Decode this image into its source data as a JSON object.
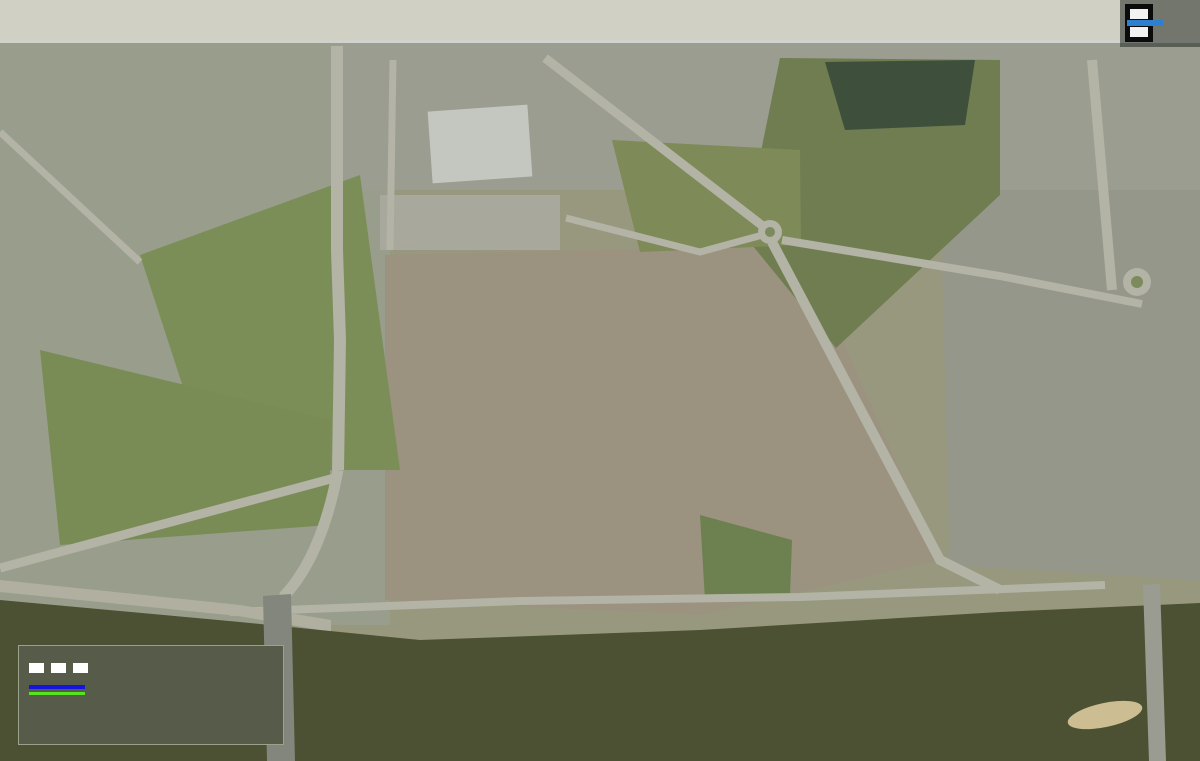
{
  "title": {
    "line1": "OBSZAR ZESPOŁU STAROMIEJSKIEGO WRAZ Z OTOCZENIEM W TORUNIU",
    "line2": "- PODZIAŁ NA KWARTAŁY URBANISTYCZNE W MPZP."
  },
  "logo": {
    "org_line1": "MIEJSKA",
    "org_line2": "PRACOWNIA",
    "org_line3": "URBANISTYCZNA",
    "org_line4": "W TORUNIU"
  },
  "legend": {
    "heading": "OZNACZENIA:",
    "items": [
      {
        "id": "plan-boundary",
        "label": "GRANICA OBSZARU OBJĘTEGO PLANEM"
      },
      {
        "id": "quarter-borders",
        "label": "GRANICE KWARTAŁÓW"
      },
      {
        "id": "quarter-symbols",
        "label": "SYMBOLE KWARTAŁÓW",
        "sample_blue": "Z.1",
        "sample_green": "O.1"
      }
    ]
  },
  "colors": {
    "quarter_blue": "#0013cc",
    "area_green": "#52de18",
    "boundary_white": "#ffffff"
  },
  "map": {
    "labels": [
      {
        "text": "O.1",
        "x": 298,
        "y": 215,
        "kind": "o"
      },
      {
        "text": "O.2",
        "x": 278,
        "y": 313,
        "kind": "o"
      },
      {
        "text": "O.3",
        "x": 217,
        "y": 350,
        "kind": "o"
      },
      {
        "text": "O.4",
        "x": 192,
        "y": 412,
        "kind": "o"
      },
      {
        "text": "O.5",
        "x": 270,
        "y": 448,
        "kind": "o"
      },
      {
        "text": "O.6",
        "x": 278,
        "y": 566,
        "kind": "o"
      },
      {
        "text": "O.6",
        "x": 487,
        "y": 597,
        "kind": "o"
      },
      {
        "text": "O.6",
        "x": 1095,
        "y": 599,
        "kind": "o"
      },
      {
        "text": "O.7",
        "x": 355,
        "y": 370,
        "kind": "o"
      },
      {
        "text": "O.8",
        "x": 390,
        "y": 551,
        "kind": "o"
      },
      {
        "text": "O.9",
        "x": 900,
        "y": 543,
        "kind": "o"
      },
      {
        "text": "O.10",
        "x": 857,
        "y": 95,
        "kind": "o"
      },
      {
        "text": "O.11",
        "x": 748,
        "y": 178,
        "kind": "o"
      },
      {
        "text": "O-12",
        "x": 605,
        "y": 158,
        "kind": "o"
      },
      {
        "text": "Z.1",
        "x": 488,
        "y": 286,
        "kind": "z"
      },
      {
        "text": "Z.2",
        "x": 432,
        "y": 299,
        "kind": "z"
      },
      {
        "text": "Z.3",
        "x": 512,
        "y": 318,
        "kind": "z"
      },
      {
        "text": "Z.4",
        "x": 480,
        "y": 353,
        "kind": "z"
      },
      {
        "text": "Z.5",
        "x": 418,
        "y": 363,
        "kind": "z"
      },
      {
        "text": "Z.6",
        "x": 475,
        "y": 401,
        "kind": "z"
      },
      {
        "text": "Z.7",
        "x": 444,
        "y": 445,
        "kind": "z"
      },
      {
        "text": "Z.8",
        "x": 402,
        "y": 496,
        "kind": "z"
      },
      {
        "text": "Z.9",
        "x": 440,
        "y": 500,
        "kind": "z"
      },
      {
        "text": "Z.10",
        "x": 426,
        "y": 538,
        "kind": "z"
      },
      {
        "text": "Z.11",
        "x": 510,
        "y": 465,
        "kind": "z"
      },
      {
        "text": "Z.12",
        "x": 503,
        "y": 511,
        "kind": "z"
      },
      {
        "text": "Z.13",
        "x": 505,
        "y": 549,
        "kind": "z"
      },
      {
        "text": "Z.14",
        "x": 574,
        "y": 557,
        "kind": "z"
      },
      {
        "text": "Z.15",
        "x": 630,
        "y": 568,
        "kind": "z"
      },
      {
        "text": "Z.16",
        "x": 676,
        "y": 560,
        "kind": "z",
        "stack": true
      },
      {
        "text": "Z.17",
        "x": 572,
        "y": 516,
        "kind": "z"
      },
      {
        "text": "Z.18",
        "x": 629,
        "y": 497,
        "kind": "z"
      },
      {
        "text": "Z.19",
        "x": 675,
        "y": 510,
        "kind": "z",
        "stack": true
      },
      {
        "text": "Z.20",
        "x": 584,
        "y": 478,
        "kind": "z"
      },
      {
        "text": "Z.21",
        "x": 573,
        "y": 420,
        "kind": "z"
      },
      {
        "text": "Z.22",
        "x": 632,
        "y": 430,
        "kind": "z"
      },
      {
        "text": "Z.23",
        "x": 568,
        "y": 350,
        "kind": "z"
      },
      {
        "text": "Z.24",
        "x": 524,
        "y": 273,
        "kind": "z"
      },
      {
        "text": "Z.25",
        "x": 626,
        "y": 308,
        "kind": "z"
      },
      {
        "text": "Z.26",
        "x": 644,
        "y": 393,
        "kind": "z"
      },
      {
        "text": "Z.27",
        "x": 674,
        "y": 380,
        "kind": "z"
      },
      {
        "text": "Z.28",
        "x": 743,
        "y": 584,
        "kind": "z"
      },
      {
        "text": "Z.29",
        "x": 741,
        "y": 514,
        "kind": "z"
      },
      {
        "text": "Z.30",
        "x": 796,
        "y": 491,
        "kind": "z"
      },
      {
        "text": "Z.31",
        "x": 769,
        "y": 461,
        "kind": "z"
      },
      {
        "text": "Z.32",
        "x": 741,
        "y": 412,
        "kind": "z"
      },
      {
        "text": "Z.33",
        "x": 712,
        "y": 364,
        "kind": "z"
      },
      {
        "text": "Z.34",
        "x": 694,
        "y": 313,
        "kind": "z",
        "stack": true
      },
      {
        "text": "Z.35",
        "x": 684,
        "y": 283,
        "kind": "z",
        "stack": true
      },
      {
        "text": "Z.36",
        "x": 716,
        "y": 276,
        "kind": "z"
      },
      {
        "text": "Z.37",
        "x": 732,
        "y": 301,
        "kind": "z"
      },
      {
        "text": "Z.38",
        "x": 758,
        "y": 347,
        "kind": "z"
      },
      {
        "text": "Z.39",
        "x": 781,
        "y": 322,
        "kind": "z",
        "rot": 78
      },
      {
        "text": "Z.40",
        "x": 784,
        "y": 392,
        "kind": "z"
      },
      {
        "text": "Z.41",
        "x": 828,
        "y": 366,
        "kind": "z"
      },
      {
        "text": "Z.42",
        "x": 861,
        "y": 399,
        "kind": "z"
      },
      {
        "text": "Z.43",
        "x": 838,
        "y": 481,
        "kind": "z"
      },
      {
        "text": "Z.44",
        "x": 884,
        "y": 449,
        "kind": "z"
      },
      {
        "text": "Z.45",
        "x": 934,
        "y": 503,
        "kind": "z"
      },
      {
        "text": "Z.46",
        "x": 981,
        "y": 533,
        "kind": "z"
      },
      {
        "text": "Z.47",
        "x": 1066,
        "y": 525,
        "kind": "z"
      },
      {
        "text": "Z.48",
        "x": 1028,
        "y": 489,
        "kind": "z"
      },
      {
        "text": "Z.49",
        "x": 989,
        "y": 441,
        "kind": "z"
      },
      {
        "text": "Z.50",
        "x": 893,
        "y": 314,
        "kind": "z"
      },
      {
        "text": "Z.51",
        "x": 818,
        "y": 272,
        "kind": "z"
      },
      {
        "text": "Z.52",
        "x": 1068,
        "y": 406,
        "kind": "z"
      },
      {
        "text": "Z.53",
        "x": 894,
        "y": 224,
        "kind": "z"
      }
    ]
  }
}
